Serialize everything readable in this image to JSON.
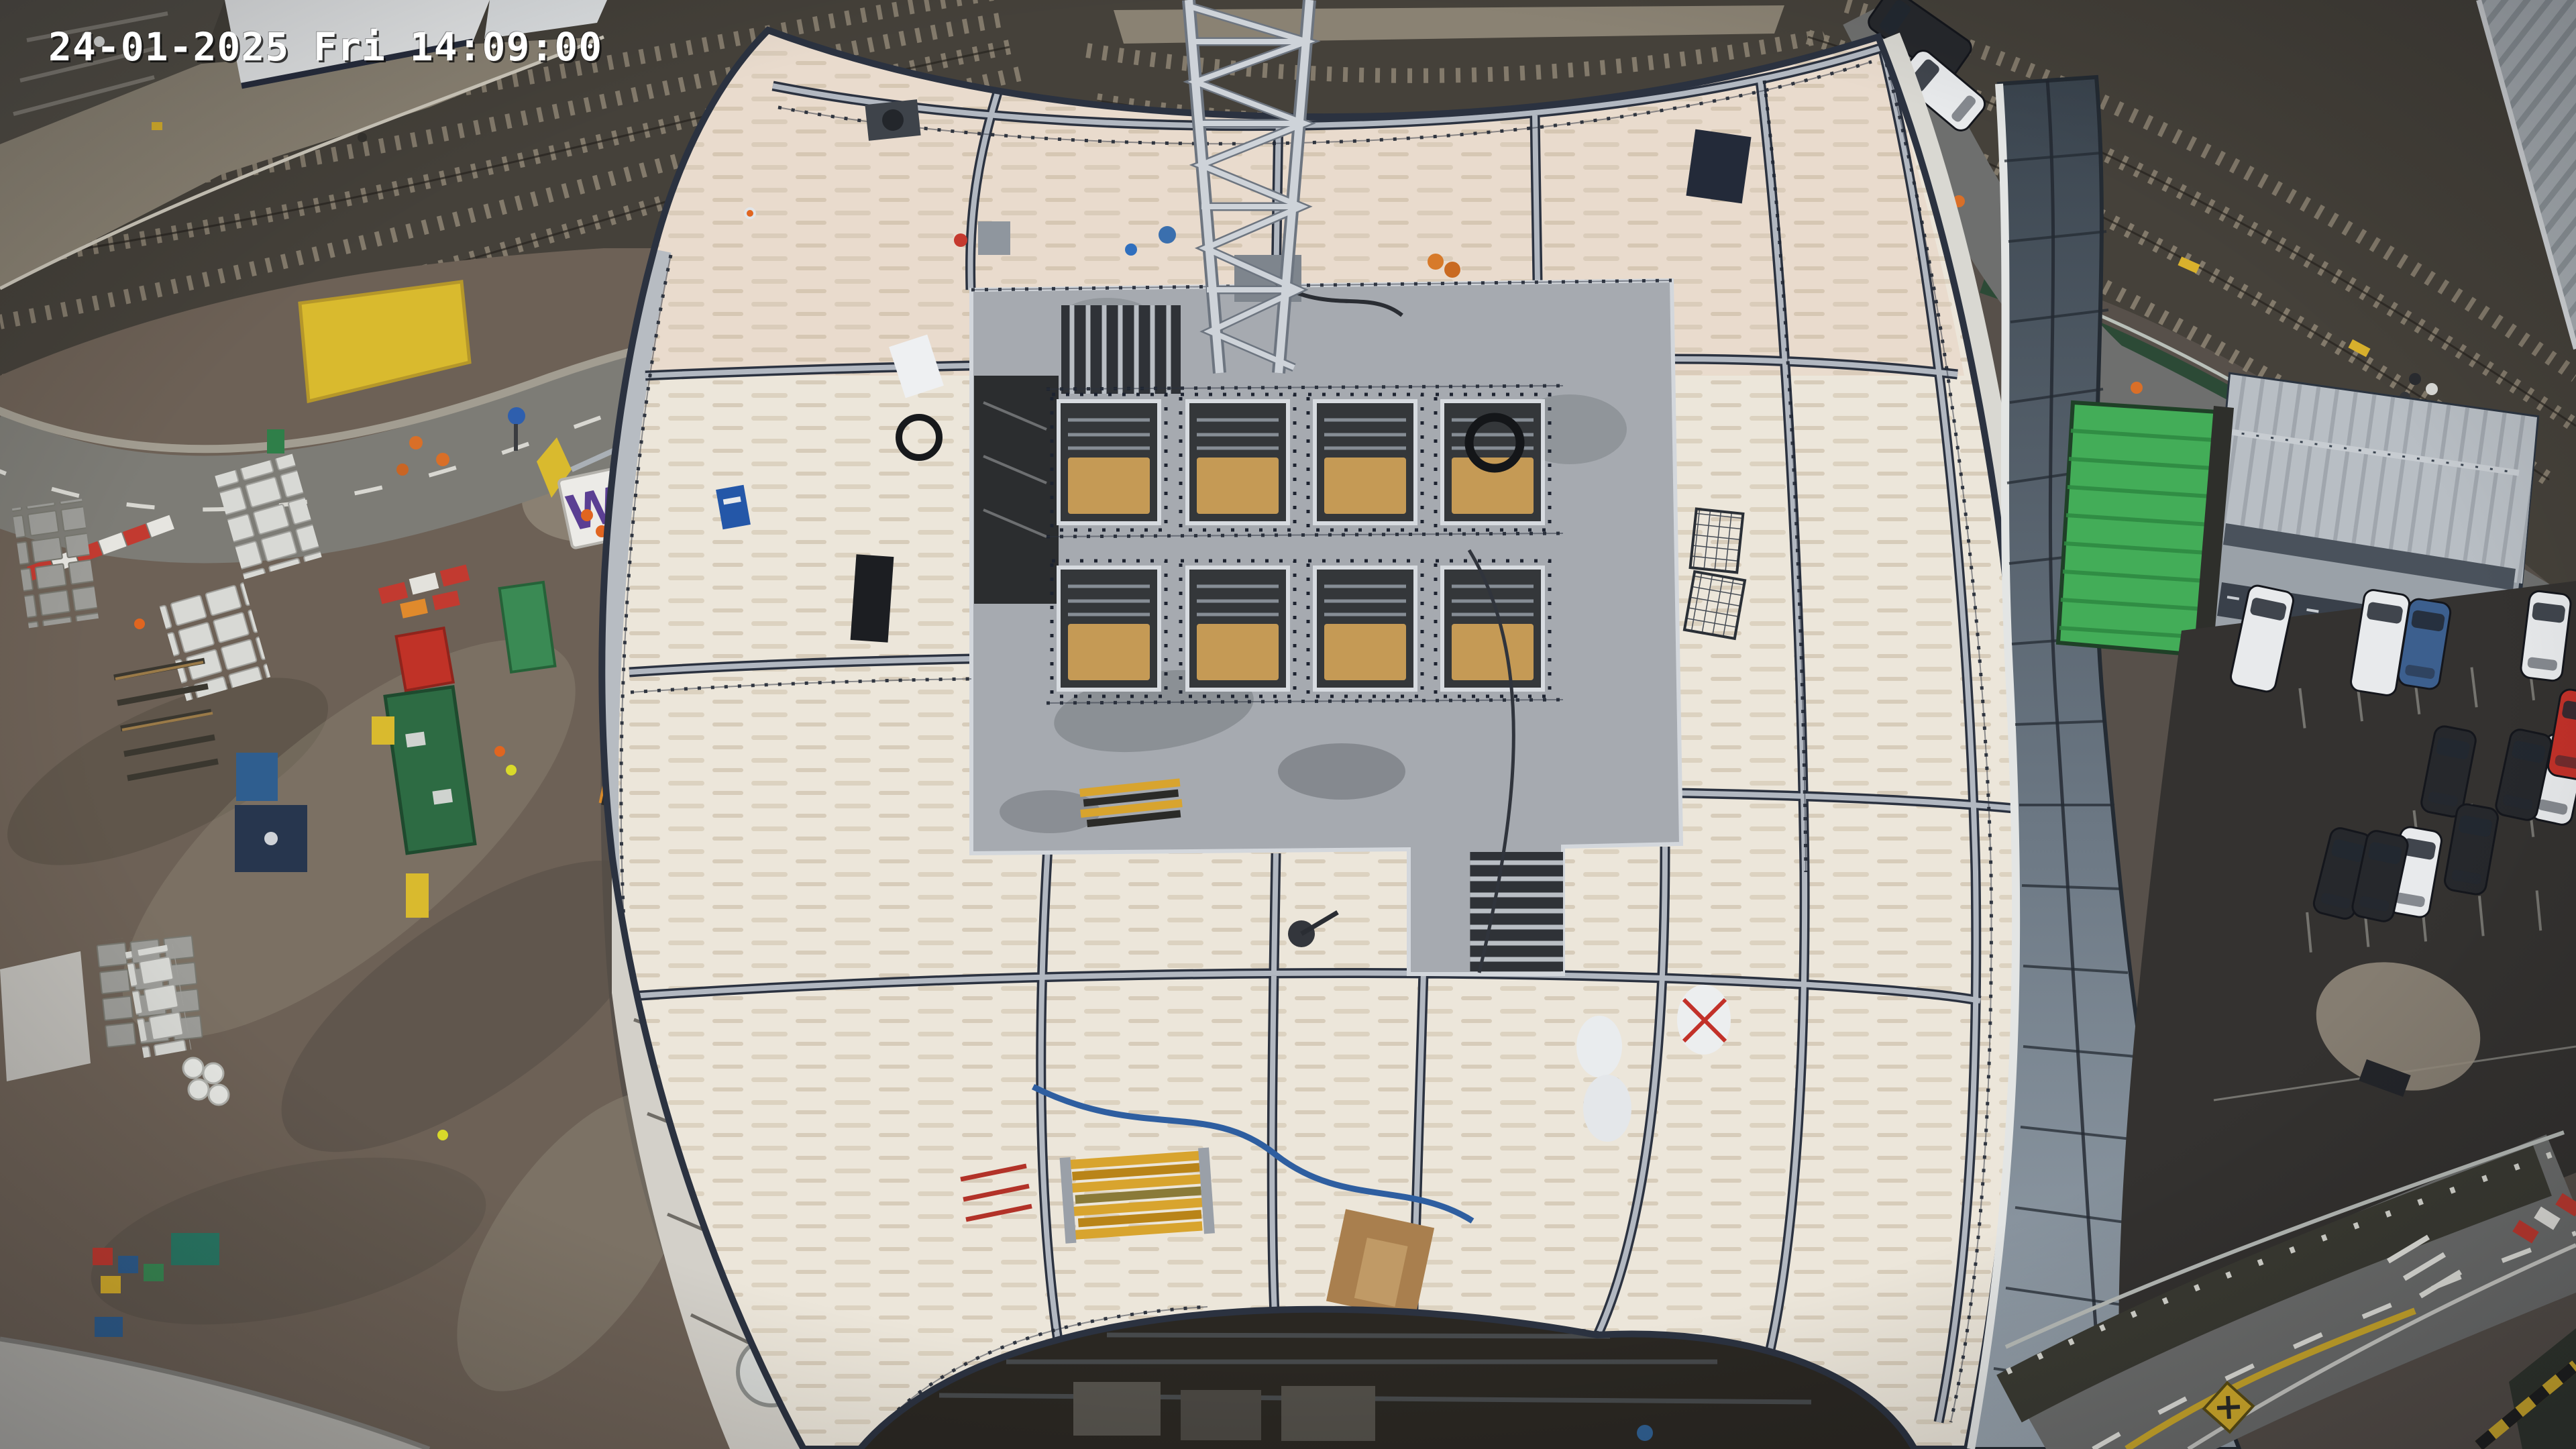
{
  "camera_overlay": {
    "timestamp": "24-01-2025 Fri 14:09:00",
    "date": "24-01-2025",
    "weekday": "Fri",
    "time": "14:09:00"
  },
  "signs": {
    "gate_letter": "W"
  },
  "palette": {
    "deck": "#ece6da",
    "deck_upper_tint": "#e5d0bf",
    "steel_dark": "#2b3240",
    "steel_light": "#b2b8c1",
    "walkway": "#b7bcc2",
    "core": "#a6aab0",
    "core_dark": "#2f3237",
    "wood": "#c59a55",
    "crane": "#ced3d9",
    "railway_ballast": "#45413a",
    "sleeper": "#8a8171",
    "platform": "#8a8273",
    "station_canopy": "#e6e8e9",
    "mud": "#6d6156",
    "mud_light": "#948b7c",
    "road": "#7d7c76",
    "road_dark": "#6e6f6e",
    "hoarding_yellow": "#d9ba2e",
    "barrier_red": "#c23a30",
    "container_green": "#2d6b43",
    "container_red": "#c03227",
    "container_blue": "#2f5e8f",
    "glass_top": "#3a444e",
    "glass_bottom": "#98a3ad",
    "green_roof": "#43ad58",
    "office_roof": "#b8bec4",
    "parking_asphalt": "#343230",
    "car_white": "#e8eaec",
    "car_dark": "#26282c",
    "car_blue": "#3c5f8e",
    "car_red": "#c23129",
    "under_deck": "#2a2722",
    "fence_green": "#2c4a36"
  }
}
